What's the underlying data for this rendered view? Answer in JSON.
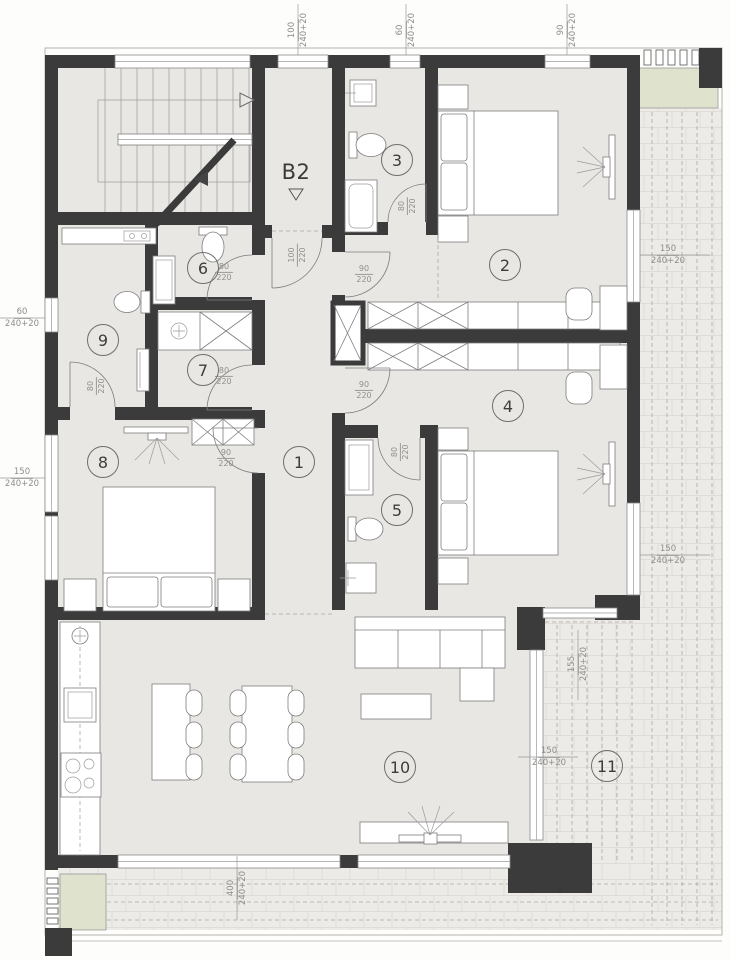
{
  "unit_label": "B2",
  "colors": {
    "wall": "#3b3b3b",
    "floor": "#e9e7e3",
    "terrace": "#edebe7",
    "planter": "#dfe2cd"
  },
  "rooms": [
    {
      "n": "1",
      "x": 299,
      "y": 462
    },
    {
      "n": "2",
      "x": 505,
      "y": 265
    },
    {
      "n": "3",
      "x": 397,
      "y": 160
    },
    {
      "n": "4",
      "x": 508,
      "y": 406
    },
    {
      "n": "5",
      "x": 397,
      "y": 510
    },
    {
      "n": "6",
      "x": 203,
      "y": 268
    },
    {
      "n": "7",
      "x": 203,
      "y": 370
    },
    {
      "n": "8",
      "x": 103,
      "y": 462
    },
    {
      "n": "9",
      "x": 103,
      "y": 340
    },
    {
      "n": "10",
      "x": 400,
      "y": 767
    },
    {
      "n": "11",
      "x": 607,
      "y": 766
    }
  ],
  "door_labels": [
    {
      "a": "100",
      "b": "220",
      "x": 297,
      "y": 255,
      "rot": 1
    },
    {
      "a": "80",
      "b": "220",
      "x": 407,
      "y": 206,
      "rot": 1
    },
    {
      "a": "90",
      "b": "220",
      "x": 364,
      "y": 274,
      "rot": 0
    },
    {
      "a": "80",
      "b": "220",
      "x": 224,
      "y": 272,
      "rot": 0
    },
    {
      "a": "80",
      "b": "220",
      "x": 224,
      "y": 376,
      "rot": 0
    },
    {
      "a": "80",
      "b": "220",
      "x": 96,
      "y": 386,
      "rot": 1
    },
    {
      "a": "90",
      "b": "220",
      "x": 226,
      "y": 458,
      "rot": 0
    },
    {
      "a": "90",
      "b": "220",
      "x": 364,
      "y": 390,
      "rot": 0
    },
    {
      "a": "80",
      "b": "220",
      "x": 400,
      "y": 452,
      "rot": 1
    }
  ],
  "dims": [
    {
      "a": "100",
      "b": "240+20",
      "x": 298,
      "y": 30,
      "o": "v"
    },
    {
      "a": "60",
      "b": "240+20",
      "x": 406,
      "y": 30,
      "o": "v"
    },
    {
      "a": "90",
      "b": "240+20",
      "x": 567,
      "y": 30,
      "o": "v"
    },
    {
      "a": "60",
      "b": "240+20",
      "x": 22,
      "y": 318,
      "o": "h"
    },
    {
      "a": "150",
      "b": "240+20",
      "x": 22,
      "y": 478,
      "o": "h"
    },
    {
      "a": "150",
      "b": "240+20",
      "x": 668,
      "y": 255,
      "o": "h"
    },
    {
      "a": "150",
      "b": "240+20",
      "x": 668,
      "y": 555,
      "o": "h"
    },
    {
      "a": "155",
      "b": "240+20",
      "x": 578,
      "y": 664,
      "o": "v"
    },
    {
      "a": "150",
      "b": "240+20",
      "x": 549,
      "y": 757,
      "o": "h"
    },
    {
      "a": "400",
      "b": "240+20",
      "x": 237,
      "y": 888,
      "o": "v"
    }
  ]
}
